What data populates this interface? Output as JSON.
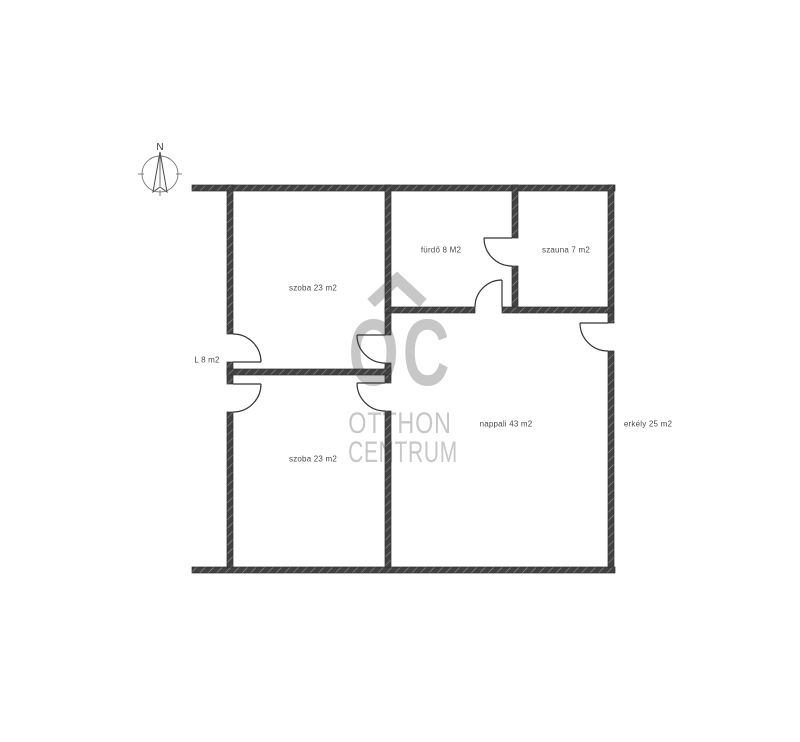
{
  "colors": {
    "wall": "#424242",
    "wall_hatch": "#9a9a9a",
    "line": "#333333",
    "label_text": "#4a4a4a",
    "watermark": "#c7c7c7",
    "background": "#ffffff"
  },
  "compass": {
    "north_label": "N"
  },
  "watermark": {
    "monogram": "OC",
    "name_line1": "OTTHON",
    "name_line2": "CENTRUM"
  },
  "rooms": {
    "szoba_upper": "szoba 23 m2",
    "furdo": "fürdő 8 M2",
    "szauna": "szauna 7 m2",
    "nappali": "nappali 43 m2",
    "erkely": "erkély 25 m2",
    "hall": "L 8 m2",
    "szoba_lower": "szoba 23 m2"
  }
}
